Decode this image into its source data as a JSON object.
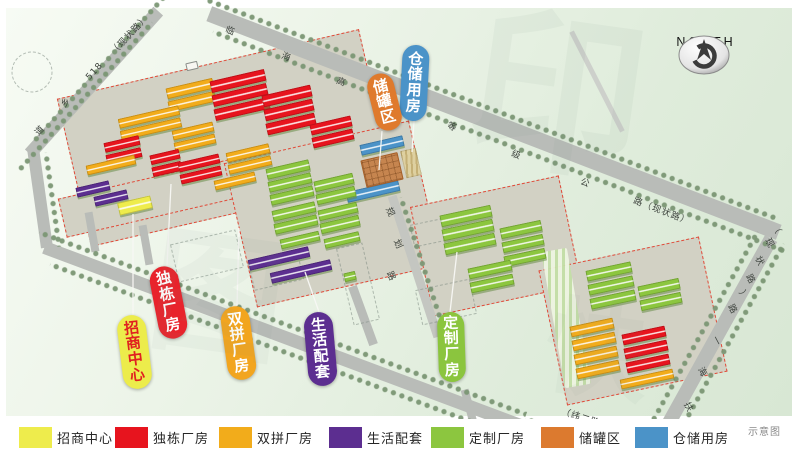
{
  "north": {
    "label": "NORTH"
  },
  "legend": {
    "note": "示意图",
    "note_x": 748,
    "items": [
      {
        "id": "zhaoshang",
        "label": "招商中心",
        "color": "#eeec4c",
        "x": 19
      },
      {
        "id": "dudong",
        "label": "独栋厂房",
        "color": "#e7141e",
        "x": 115
      },
      {
        "id": "shuangpin",
        "label": "双拼厂房",
        "color": "#f2ac1b",
        "x": 219
      },
      {
        "id": "shenghuo",
        "label": "生活配套",
        "color": "#5c2e90",
        "x": 329
      },
      {
        "id": "dingzhi",
        "label": "定制厂房",
        "color": "#8cc63f",
        "x": 431
      },
      {
        "id": "chuguan",
        "label": "储罐区",
        "color": "#dc7a2f",
        "x": 541
      },
      {
        "id": "cangchu",
        "label": "仓储用房",
        "color": "#4b93c8",
        "x": 635
      }
    ]
  },
  "palette": {
    "zhaoshang": "#eeec4c",
    "dudong": "#e7141e",
    "shuangpin": "#f2ac1b",
    "shenghuo": "#5c2e90",
    "dingzhi": "#8cc63f",
    "chuguan": "#dc7a2f",
    "cangchu": "#4b93c8",
    "tank": "#c6854f",
    "hatch": "#ded0a0",
    "marker": "#f7f7f2"
  },
  "callouts": [
    {
      "id": "cangchu",
      "text": "仓储用房",
      "bg": "#4b93c8",
      "fg": "#ffffff",
      "cx": 414,
      "cy": 83,
      "w": 27,
      "h": 76,
      "rot": 3,
      "line": [
        414,
        121,
        412,
        152
      ]
    },
    {
      "id": "chuguan",
      "text": "储罐区",
      "bg": "#df7a2d",
      "fg": "#ffffff",
      "cx": 384,
      "cy": 102,
      "w": 27,
      "h": 58,
      "rot": -14,
      "line": [
        382,
        131,
        379,
        170
      ]
    },
    {
      "id": "dudong",
      "text": "独栋厂房",
      "bg": "#e8232c",
      "fg": "#ffffff",
      "cx": 168,
      "cy": 302,
      "w": 29,
      "h": 73,
      "rot": -11,
      "line": [
        167,
        266,
        171,
        184
      ]
    },
    {
      "id": "zhaoshang",
      "text": "招商中心",
      "bg": "#ecec4b",
      "fg": "#e02020",
      "cx": 134,
      "cy": 352,
      "w": 29,
      "h": 74,
      "rot": -7,
      "line": [
        133,
        315,
        133,
        214
      ]
    },
    {
      "id": "shuangpin",
      "text": "双拼厂房",
      "bg": "#f2a51f",
      "fg": "#ffffff",
      "cx": 238,
      "cy": 343,
      "w": 29,
      "h": 74,
      "rot": -8,
      "line": [
        237,
        306,
        239,
        228
      ]
    },
    {
      "id": "shenghuo",
      "text": "生活配套",
      "bg": "#5c2e90",
      "fg": "#ffffff",
      "cx": 320,
      "cy": 349,
      "w": 29,
      "h": 74,
      "rot": -5,
      "line": [
        319,
        312,
        305,
        272
      ]
    },
    {
      "id": "dingzhi",
      "text": "定制厂房",
      "bg": "#8bc53e",
      "fg": "#ffffff",
      "cx": 451,
      "cy": 347,
      "w": 27,
      "h": 70,
      "rot": -2,
      "line": [
        450,
        312,
        457,
        252
      ]
    }
  ],
  "map": {
    "parcels": [
      [
        225,
        138,
        310,
        152,
        -13
      ],
      [
        150,
        198,
        180,
        40,
        -13
      ],
      [
        333,
        214,
        190,
        148,
        -13
      ],
      [
        496,
        246,
        152,
        112,
        -12
      ],
      [
        633,
        321,
        164,
        138,
        -12
      ]
    ],
    "roads": [
      [
        94,
        82,
        192,
        13,
        132,
        ""
      ],
      [
        40,
        198,
        100,
        12,
        82,
        ""
      ],
      [
        288,
        338,
        520,
        13,
        20.5,
        ""
      ],
      [
        597,
        441,
        140,
        12,
        10.5,
        ""
      ],
      [
        494,
        123,
        610,
        16,
        21,
        ""
      ],
      [
        711,
        347,
        248,
        14,
        119,
        ""
      ],
      [
        415,
        266,
        148,
        9,
        72,
        "#c4c6c1"
      ],
      [
        597,
        81,
        112,
        5,
        63,
        "#cdd0cb"
      ],
      [
        363,
        315,
        62,
        9,
        70,
        ""
      ],
      [
        92,
        232,
        40,
        8,
        80,
        ""
      ],
      [
        146,
        245,
        40,
        8,
        80,
        ""
      ],
      [
        470,
        410,
        42,
        8,
        75,
        ""
      ]
    ],
    "treelines": [
      [
        101,
        68,
        200,
        132
      ],
      [
        86,
        97,
        200,
        132
      ],
      [
        490,
        107,
        612,
        21
      ],
      [
        499,
        140,
        612,
        21
      ],
      [
        698,
        341,
        250,
        119
      ],
      [
        724,
        353,
        250,
        119
      ],
      [
        283,
        322,
        520,
        20.5
      ],
      [
        294,
        354,
        520,
        20.5
      ],
      [
        594,
        431,
        140,
        10.5
      ],
      [
        425,
        268,
        150,
        72
      ],
      [
        53,
        199,
        95,
        82
      ]
    ],
    "buffer": [
      566,
      318,
      138,
      26,
      80
    ],
    "buildings": [
      [
        166,
        83,
        48,
        11,
        -13,
        "shuangpin"
      ],
      [
        168,
        96,
        48,
        11,
        -13,
        "shuangpin"
      ],
      [
        118,
        112,
        62,
        10,
        -13,
        "shuangpin"
      ],
      [
        120,
        124,
        62,
        10,
        -13,
        "shuangpin"
      ],
      [
        104,
        139,
        36,
        10,
        -13,
        "dudong"
      ],
      [
        106,
        151,
        36,
        10,
        -13,
        "dudong"
      ],
      [
        86,
        160,
        50,
        10,
        -13,
        "shuangpin"
      ],
      [
        172,
        126,
        42,
        10,
        -13,
        "shuangpin"
      ],
      [
        174,
        138,
        42,
        10,
        -13,
        "shuangpin"
      ],
      [
        150,
        152,
        30,
        10,
        -13,
        "dudong"
      ],
      [
        152,
        164,
        30,
        10,
        -13,
        "dudong"
      ],
      [
        178,
        158,
        42,
        10,
        -13,
        "dudong"
      ],
      [
        180,
        170,
        42,
        10,
        -13,
        "dudong"
      ],
      [
        226,
        148,
        44,
        10,
        -13,
        "shuangpin"
      ],
      [
        228,
        160,
        44,
        10,
        -13,
        "shuangpin"
      ],
      [
        214,
        176,
        42,
        10,
        -13,
        "shuangpin"
      ],
      [
        210,
        75,
        56,
        12,
        -13,
        "dudong"
      ],
      [
        212,
        89,
        56,
        12,
        -13,
        "dudong"
      ],
      [
        214,
        103,
        56,
        12,
        -13,
        "dudong"
      ],
      [
        262,
        90,
        50,
        12,
        -13,
        "dudong"
      ],
      [
        264,
        104,
        50,
        12,
        -13,
        "dudong"
      ],
      [
        266,
        118,
        50,
        12,
        -13,
        "dudong"
      ],
      [
        310,
        120,
        42,
        11,
        -13,
        "dudong"
      ],
      [
        312,
        133,
        42,
        11,
        -13,
        "dudong"
      ],
      [
        76,
        184,
        34,
        10,
        -13,
        "shenghuo"
      ],
      [
        94,
        193,
        34,
        10,
        -13,
        "shenghuo"
      ],
      [
        118,
        199,
        34,
        13,
        -13,
        "zhaoshang"
      ],
      [
        360,
        140,
        44,
        11,
        -13,
        "cangchu"
      ],
      [
        346,
        186,
        54,
        11,
        -13,
        "cangchu"
      ],
      [
        363,
        156,
        38,
        28,
        -13,
        "tank"
      ],
      [
        403,
        149,
        16,
        28,
        -13,
        "hatch"
      ],
      [
        266,
        164,
        44,
        11,
        -13,
        "dingzhi"
      ],
      [
        268,
        177,
        44,
        11,
        -13,
        "dingzhi"
      ],
      [
        270,
        190,
        44,
        11,
        -13,
        "dingzhi"
      ],
      [
        314,
        177,
        40,
        11,
        -13,
        "dingzhi"
      ],
      [
        316,
        190,
        40,
        11,
        -13,
        "dingzhi"
      ],
      [
        272,
        206,
        44,
        11,
        -13,
        "dingzhi"
      ],
      [
        274,
        219,
        44,
        11,
        -13,
        "dingzhi"
      ],
      [
        318,
        206,
        40,
        11,
        -13,
        "dingzhi"
      ],
      [
        320,
        219,
        40,
        11,
        -13,
        "dingzhi"
      ],
      [
        280,
        235,
        40,
        10,
        -13,
        "dingzhi"
      ],
      [
        324,
        235,
        36,
        10,
        -13,
        "dingzhi"
      ],
      [
        248,
        253,
        62,
        11,
        -13,
        "shenghuo"
      ],
      [
        270,
        266,
        62,
        11,
        -13,
        "shenghuo"
      ],
      [
        344,
        272,
        12,
        9,
        -13,
        "dingzhi"
      ],
      [
        440,
        210,
        52,
        12,
        -12,
        "dingzhi"
      ],
      [
        442,
        224,
        52,
        12,
        -12,
        "dingzhi"
      ],
      [
        444,
        238,
        52,
        12,
        -12,
        "dingzhi"
      ],
      [
        500,
        224,
        42,
        11,
        -12,
        "dingzhi"
      ],
      [
        502,
        238,
        42,
        11,
        -12,
        "dingzhi"
      ],
      [
        504,
        252,
        42,
        11,
        -12,
        "dingzhi"
      ],
      [
        468,
        264,
        44,
        11,
        -12,
        "dingzhi"
      ],
      [
        470,
        278,
        44,
        11,
        -12,
        "dingzhi"
      ],
      [
        586,
        266,
        46,
        11,
        -12,
        "dingzhi"
      ],
      [
        588,
        280,
        46,
        11,
        -12,
        "dingzhi"
      ],
      [
        590,
        294,
        46,
        11,
        -12,
        "dingzhi"
      ],
      [
        638,
        282,
        42,
        11,
        -12,
        "dingzhi"
      ],
      [
        640,
        296,
        42,
        11,
        -12,
        "dingzhi"
      ],
      [
        570,
        322,
        44,
        11,
        -12,
        "shuangpin"
      ],
      [
        572,
        336,
        44,
        11,
        -12,
        "shuangpin"
      ],
      [
        574,
        350,
        44,
        11,
        -12,
        "shuangpin"
      ],
      [
        576,
        364,
        44,
        11,
        -12,
        "shuangpin"
      ],
      [
        622,
        330,
        44,
        11,
        -12,
        "dudong"
      ],
      [
        624,
        344,
        44,
        11,
        -12,
        "dudong"
      ],
      [
        626,
        358,
        44,
        11,
        -12,
        "dudong"
      ],
      [
        620,
        374,
        54,
        10,
        -12,
        "shuangpin"
      ],
      [
        186,
        62,
        12,
        8,
        -13,
        "marker"
      ]
    ],
    "road_labels": [
      [
        "临",
        226,
        22,
        21
      ],
      [
        "海",
        282,
        48,
        21
      ],
      [
        "高",
        337,
        73,
        21
      ],
      [
        "等",
        448,
        118,
        21
      ],
      [
        "级",
        512,
        146,
        21
      ],
      [
        "公",
        581,
        174,
        21
      ],
      [
        "路（现状路）",
        634,
        193,
        21
      ],
      [
        "（现状路）",
        112,
        46,
        -47
      ],
      [
        "518",
        88,
        74,
        -47
      ],
      [
        "乡",
        62,
        99,
        -47
      ],
      [
        "道",
        36,
        127,
        -47
      ],
      [
        "（",
        775,
        218,
        62
      ],
      [
        "现",
        768,
        232,
        62
      ],
      [
        "状",
        758,
        250,
        62
      ],
      [
        "路",
        749,
        268,
        62
      ],
      [
        "）",
        742,
        284,
        62
      ],
      [
        "路",
        731,
        298,
        62
      ],
      [
        "一",
        715,
        330,
        62
      ],
      [
        "海",
        701,
        361,
        62
      ],
      [
        "扶",
        687,
        396,
        62
      ],
      [
        "路",
        523,
        419,
        18
      ],
      [
        "（纬二路）",
        562,
        404,
        18
      ],
      [
        "规",
        389,
        201,
        66
      ],
      [
        "划",
        397,
        233,
        66
      ],
      [
        "路",
        390,
        265,
        66
      ]
    ],
    "dashed_rects": [
      [
        207,
        256,
        66,
        38,
        -13
      ],
      [
        276,
        271,
        50,
        28,
        -13
      ],
      [
        446,
        302,
        55,
        35,
        -12
      ],
      [
        358,
        284,
        26,
        78,
        -13
      ],
      [
        432,
        232,
        40,
        22,
        -12
      ]
    ],
    "pond": [
      32,
      72,
      20
    ],
    "watermarks": [
      {
        "t": "印",
        "x": 470,
        "y": 10,
        "s": 175,
        "o": 0.07,
        "r": 8
      },
      {
        "t": "图",
        "x": 150,
        "y": 230,
        "s": 135,
        "o": 0.06,
        "r": 8
      },
      {
        "t": "快",
        "x": 545,
        "y": 300,
        "s": 105,
        "o": 0.05,
        "r": 8
      }
    ]
  }
}
